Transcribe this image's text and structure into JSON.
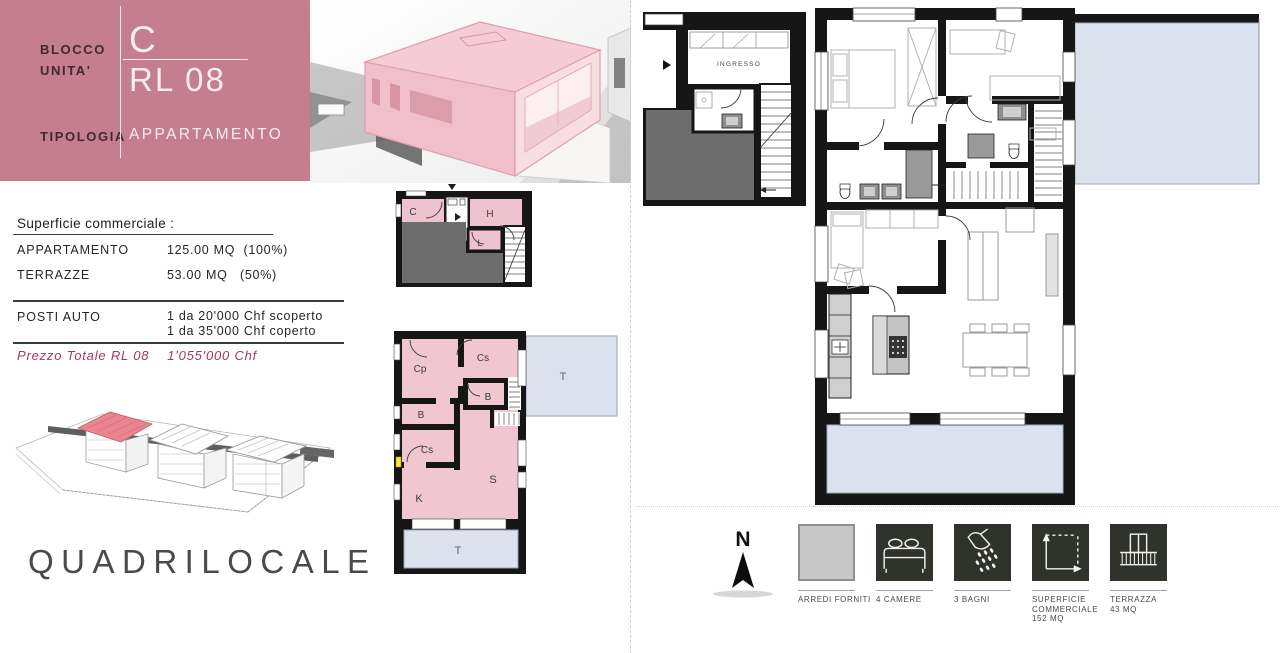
{
  "header": {
    "rows": [
      {
        "label": "BLOCCO",
        "value": "C"
      },
      {
        "label": "UNITA'",
        "value": "RL 08"
      },
      {
        "label": "TIPOLOGIA",
        "value": "APPARTAMENTO"
      }
    ]
  },
  "surface": {
    "title": "Superficie commerciale :",
    "rows": [
      {
        "label": "APPARTAMENTO",
        "value": "125.00 MQ",
        "percent": "(100%)"
      },
      {
        "label": "TERRAZZE",
        "value": "53.00 MQ",
        "percent": "(50%)"
      }
    ]
  },
  "parking": {
    "label": "POSTI AUTO",
    "options": [
      "1 da 20'000 Chf scoperto",
      "1 da 35'000 Chf coperto"
    ]
  },
  "price": {
    "label": "Prezzo Totale RL 08",
    "value": "1'055'000 Chf"
  },
  "apartment_type": "QUADRILOCALE",
  "floorplan": {
    "entrance_label": "INGRESSO",
    "cellar_rooms": {
      "c": "C",
      "h": "H",
      "l": "L"
    },
    "key_rooms": {
      "cp": "Cp",
      "cs_top": "Cs",
      "b_small": "B",
      "b_left": "B",
      "cs_left": "Cs",
      "k": "K",
      "s": "S",
      "terrace_right": "T",
      "terrace_bottom": "T"
    }
  },
  "legend": {
    "north_label": "N",
    "items": [
      {
        "name": "arredi-forniti",
        "lines": [
          "ARREDI FORNITI"
        ]
      },
      {
        "name": "camere",
        "lines": [
          "4 CAMERE"
        ]
      },
      {
        "name": "bagni",
        "lines": [
          "3 BAGNI"
        ]
      },
      {
        "name": "superficie-commerciale",
        "lines": [
          "SUPERFICIE",
          "COMMERCIALE",
          "152 MQ"
        ]
      },
      {
        "name": "terrazza",
        "lines": [
          "TERRAZZA",
          "43 MQ"
        ]
      }
    ]
  },
  "colors": {
    "header_pink": "#c57e8f",
    "plan_pink": "#f0c6d1",
    "terrace_blue": "#dbe2ee",
    "roof_gray": "#6d6d6d",
    "legend_dark": "#2f332c",
    "price_red": "#a73b55",
    "highlight_pink": "#f2c4cf"
  }
}
